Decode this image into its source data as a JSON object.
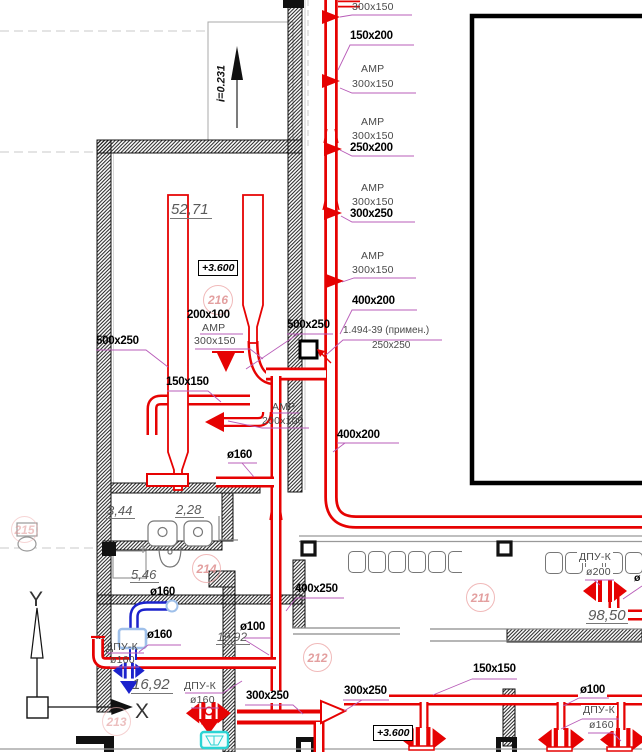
{
  "slope_label": "i=0.231",
  "elevation": {
    "badge1": "+3.600",
    "badge2": "+3.600"
  },
  "axis": {
    "y": "Y",
    "x": "X"
  },
  "riser_callouts": {
    "c1": "300x150",
    "c2": "150x200",
    "amp1": "АМР",
    "s1": "300x150",
    "amp2": "АМР",
    "s2": "300x150",
    "c3": "250x200",
    "amp3": "АМР",
    "s3": "300x150",
    "c4": "300x250",
    "amp4": "АМР",
    "s4": "300x150",
    "c5": "400x200",
    "c6": "500x250",
    "damper_note_line1": "1.494-39 (примен.)",
    "damper_note_line2": "250x250",
    "c7": "400x200"
  },
  "room216": {
    "circle": "216",
    "area": "52,71",
    "size1": "200x100",
    "amp": "АМР",
    "size2": "300x150",
    "size3": "500x250",
    "size4": "150x150",
    "amp2": "АМР",
    "size5": "200x100",
    "size6": "ø160"
  },
  "washroom": {
    "a1": "3,44",
    "a2": "2,28",
    "a3": "5,46",
    "c215": "215",
    "c214": "214"
  },
  "bottom_left": {
    "d160a": "ø160",
    "d160b": "ø160",
    "dpu1": "ДПУ-К",
    "dpu1d": "ø160",
    "area": "16,92",
    "c213": "213",
    "dpu2": "ДПУ-К",
    "dpu2d": "ø160"
  },
  "bottom_center": {
    "size1": "400x250",
    "d100": "ø100",
    "area": "19,92",
    "c212": "212",
    "size2": "300x250",
    "size3": "300x250"
  },
  "right": {
    "c211": "211",
    "dpu3": "ДПУ-К",
    "dpu3d": "ø200",
    "area": "98,50",
    "edge_partial": "ø",
    "size1": "150x150",
    "d100": "ø100",
    "dpu4": "ДПУ-К",
    "dpu4d": "ø160"
  },
  "colors": {
    "duct_red": "#e60202",
    "duct_blue": "#1b22cc",
    "leader_magenta": "#b85cb8",
    "room_tag_pink": "#e09595",
    "drain_cyan": "#2bd4d4",
    "pale_blue": "#9fc0ea"
  }
}
